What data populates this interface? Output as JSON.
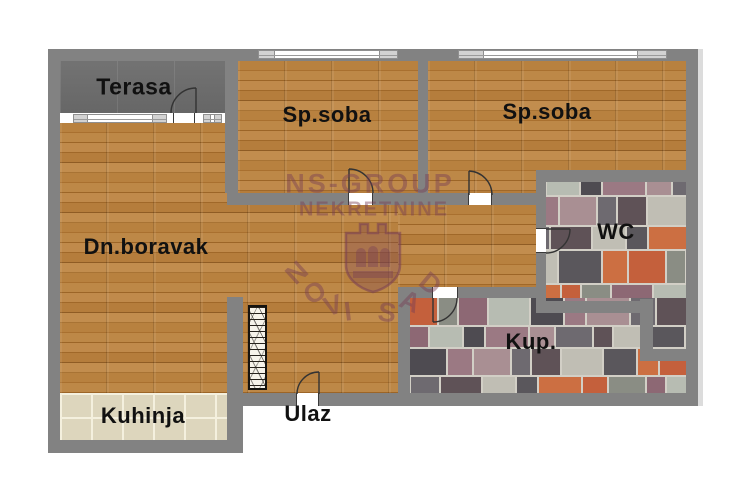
{
  "plan_title": "Apartment floor plan",
  "agency_watermark": {
    "line1": "NS-GROUP",
    "line2": "NEKRETNINE",
    "arc_text": "NOVI SAD",
    "arc_letters": [
      "N",
      "O",
      "V",
      "I",
      "S",
      "A",
      "D"
    ]
  },
  "rooms": [
    {
      "id": "terasa",
      "label": "Terasa"
    },
    {
      "id": "sp_soba_1",
      "label": "Sp.soba"
    },
    {
      "id": "sp_soba_2",
      "label": "Sp.soba"
    },
    {
      "id": "dn_boravak",
      "label": "Dn.boravak"
    },
    {
      "id": "wc",
      "label": "WC"
    },
    {
      "id": "kup",
      "label": "Kup."
    },
    {
      "id": "kuhinja",
      "label": "Kuhinja"
    },
    {
      "id": "ulaz",
      "label": "Ulaz"
    }
  ],
  "colors": {
    "wall": "#828282",
    "wood_floor": "#b07a3c",
    "terrace_floor": "#6d6d6d",
    "kitchen_tile": "#ddd6bd",
    "tile_grout": "#d2cfc6",
    "watermark": "#783e54",
    "label_text": "#111111",
    "mosaic_palette": [
      "#b7bcb2",
      "#5a575c",
      "#9b7983",
      "#c4603c",
      "#6e6a70",
      "#8d6874",
      "#c0beb4",
      "#4e4b51",
      "#cc6f42",
      "#a98f93",
      "#8a8d84",
      "#5f5257"
    ]
  }
}
